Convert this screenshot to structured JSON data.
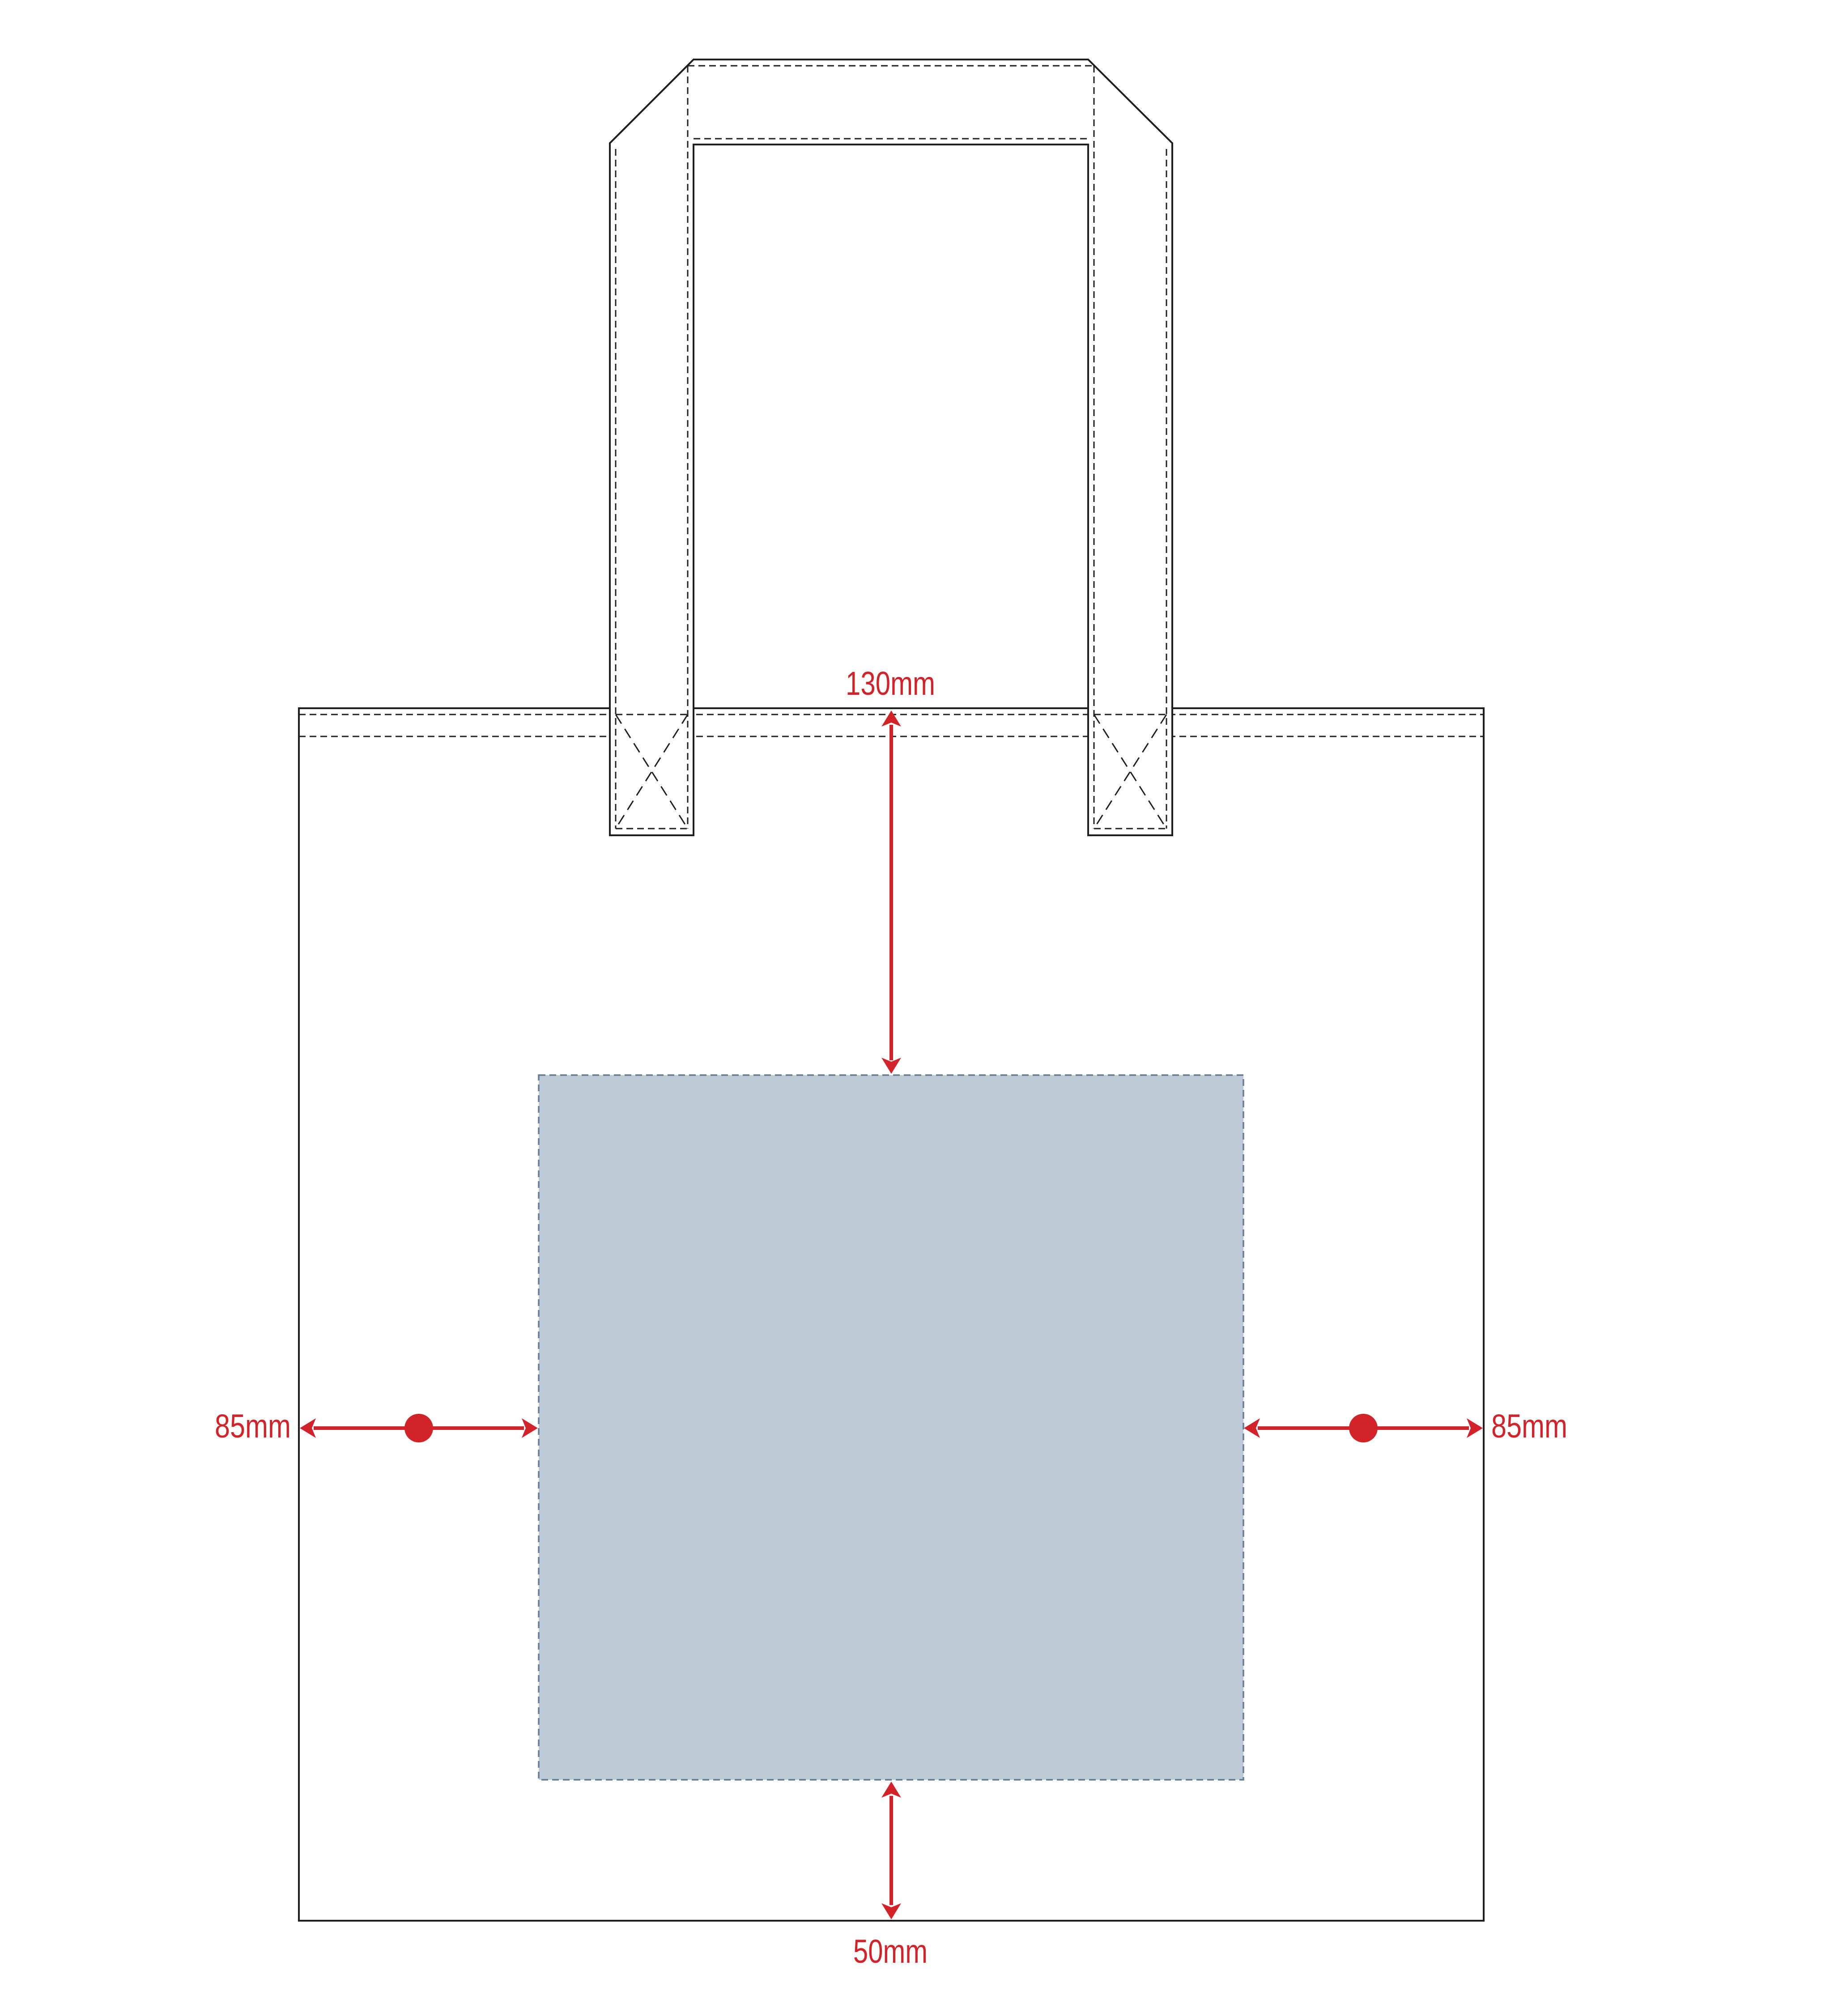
{
  "diagram": {
    "type": "tote-bag-print-placement-guide",
    "labels": {
      "top_offset": "130mm",
      "left_offset": "85mm",
      "right_offset": "85mm",
      "bottom_offset": "50mm"
    },
    "colors": {
      "accent_red": "#d2232a",
      "print_area_fill": "#bec9d6",
      "print_area_border": "#647e99",
      "outline": "#1f1f1f",
      "background": "#ffffff"
    }
  }
}
